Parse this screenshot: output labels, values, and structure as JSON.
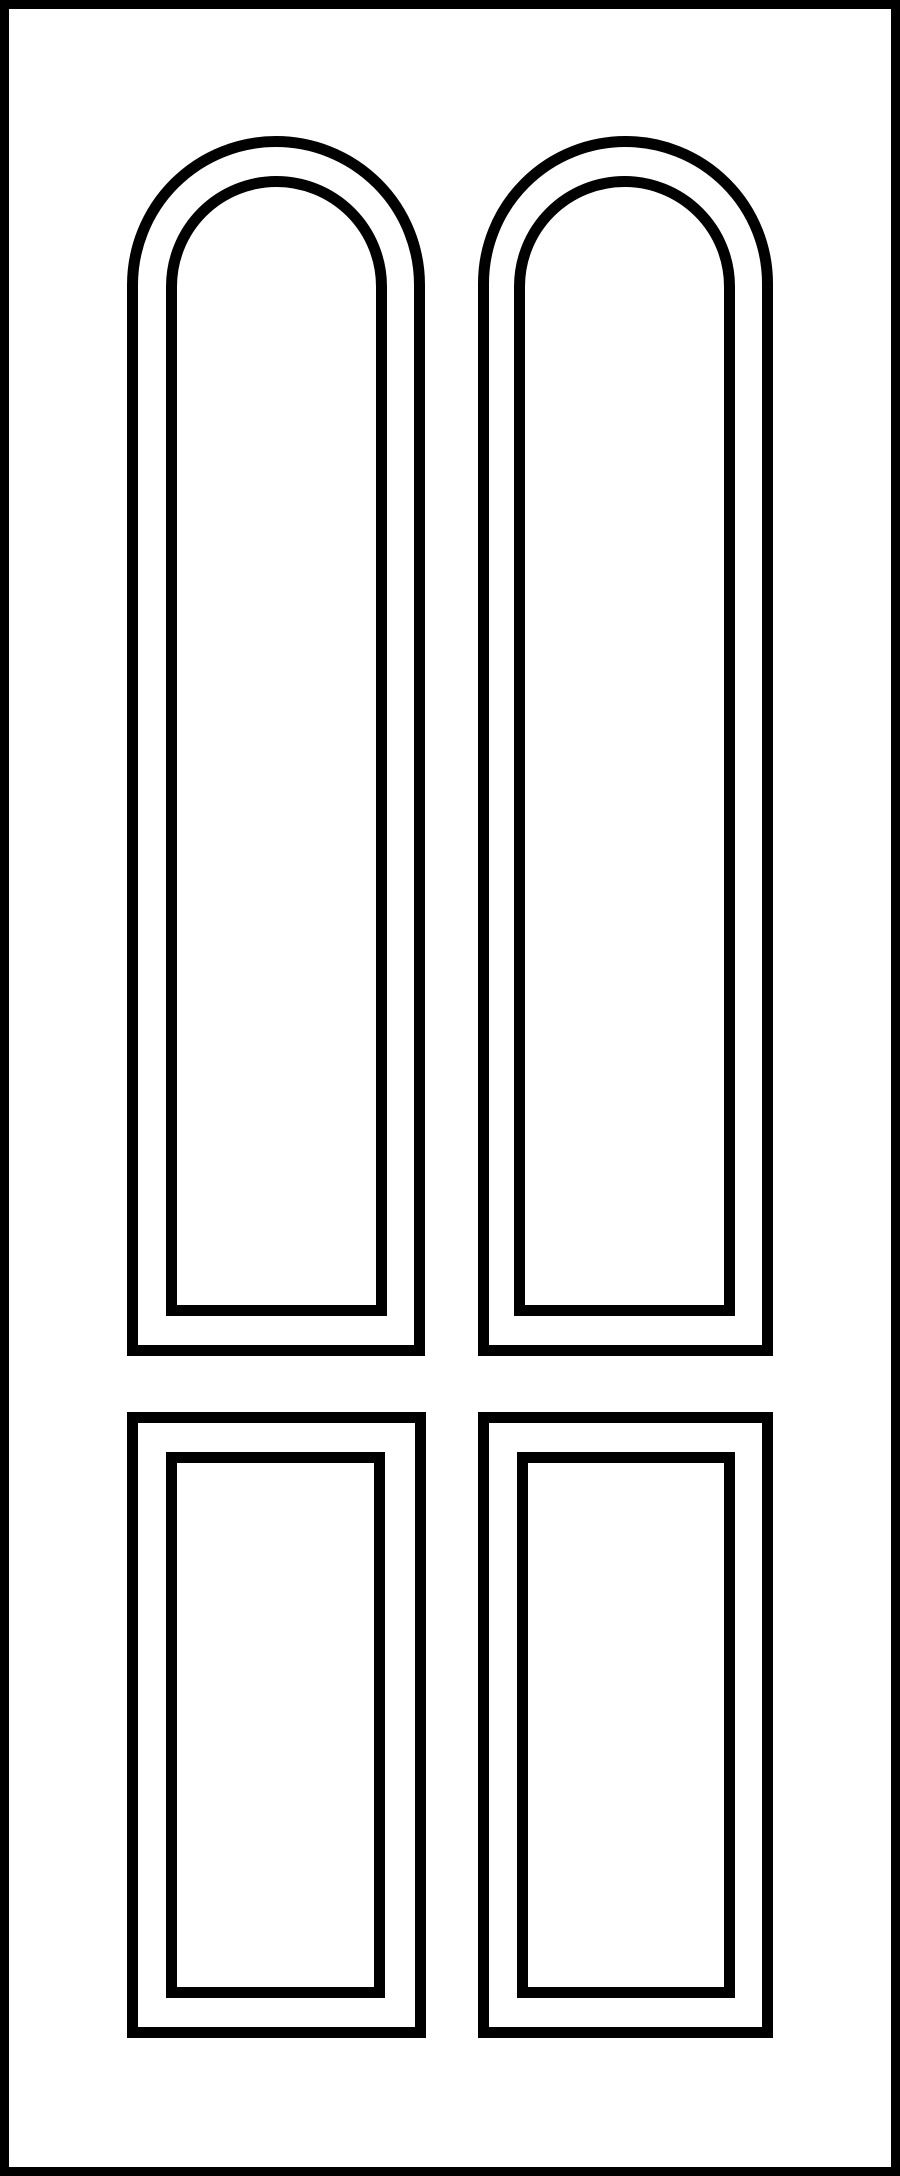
{
  "illustration": {
    "title": "Four-panel door line drawing: two arched top panels and two rectangular bottom panels",
    "colors": {
      "line": "#000000",
      "background": "#ffffff"
    },
    "canvas": {
      "width": 900,
      "height": 2176
    },
    "frame": {
      "x": 0,
      "y": 0,
      "w": 900,
      "h": 2176,
      "stroke": 9,
      "radius": 0
    },
    "panels": [
      {
        "id": "top-left-arched",
        "shape": "arched",
        "outer": {
          "x": 127,
          "y": 136,
          "w": 298,
          "h": 1220,
          "stroke": 11,
          "radius": 149
        },
        "inner": {
          "x": 166,
          "y": 176,
          "w": 221,
          "h": 1140,
          "stroke": 11,
          "radius": 111
        }
      },
      {
        "id": "top-right-arched",
        "shape": "arched",
        "outer": {
          "x": 478,
          "y": 136,
          "w": 295,
          "h": 1220,
          "stroke": 11,
          "radius": 148
        },
        "inner": {
          "x": 514,
          "y": 176,
          "w": 221,
          "h": 1140,
          "stroke": 11,
          "radius": 111
        }
      },
      {
        "id": "bottom-left-rect",
        "shape": "rect",
        "outer": {
          "x": 127,
          "y": 1412,
          "w": 299,
          "h": 626,
          "stroke": 11,
          "radius": 0
        },
        "inner": {
          "x": 166,
          "y": 1452,
          "w": 219,
          "h": 546,
          "stroke": 11,
          "radius": 0
        }
      },
      {
        "id": "bottom-right-rect",
        "shape": "rect",
        "outer": {
          "x": 478,
          "y": 1412,
          "w": 295,
          "h": 626,
          "stroke": 11,
          "radius": 0
        },
        "inner": {
          "x": 517,
          "y": 1452,
          "w": 218,
          "h": 546,
          "stroke": 11,
          "radius": 0
        }
      }
    ]
  }
}
